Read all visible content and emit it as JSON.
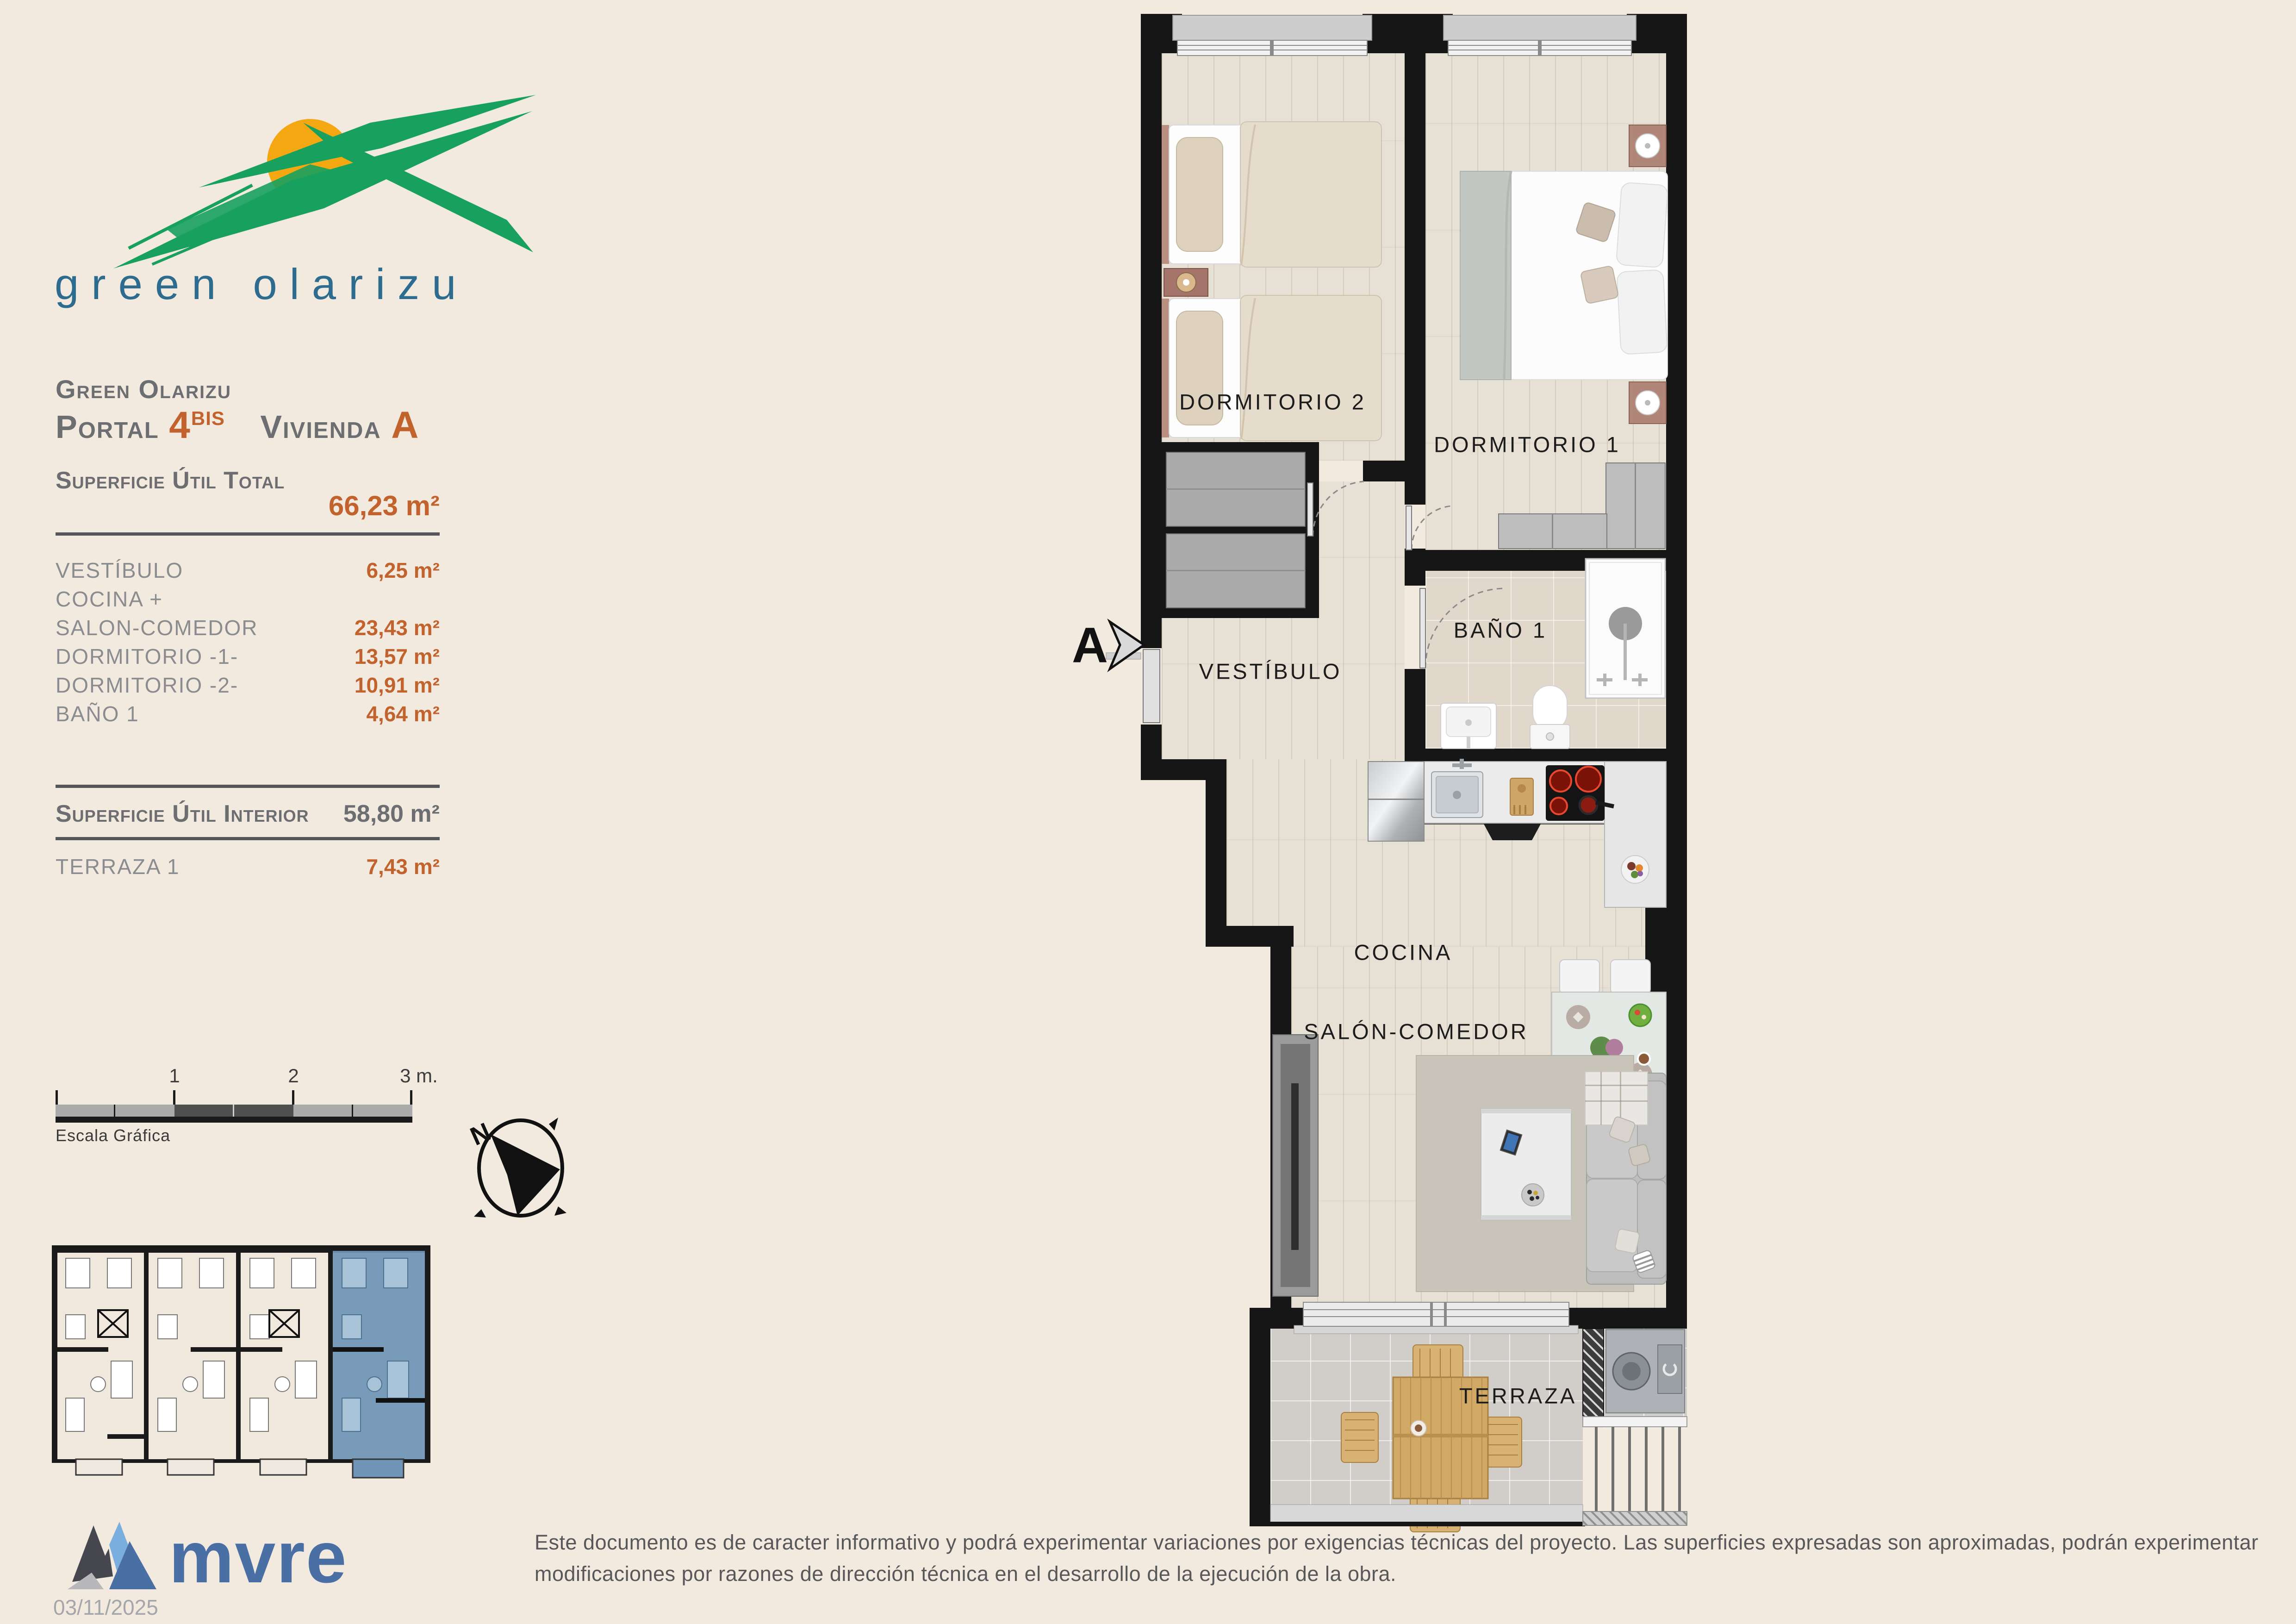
{
  "logo": {
    "text": "green olarizu"
  },
  "header": {
    "project_name": "Green Olarizu",
    "portal_label": "Portal",
    "portal_number": "4",
    "portal_sup": "BIS",
    "vivienda_label": "Vivienda",
    "vivienda_letter": "A"
  },
  "surface_total": {
    "label": "Superficie Útil Total",
    "value": "66,23 m²"
  },
  "rooms": [
    {
      "label": "VESTÍBULO",
      "value": "6,25 m²"
    },
    {
      "label": "COCINA +",
      "value": ""
    },
    {
      "label": "SALON-COMEDOR",
      "value": "23,43 m²"
    },
    {
      "label": "DORMITORIO -1-",
      "value": "13,57 m²"
    },
    {
      "label": "DORMITORIO -2-",
      "value": "10,91 m²"
    },
    {
      "label": "BAÑO 1",
      "value": "4,64 m²"
    }
  ],
  "surface_interior": {
    "label": "Superficie Útil Interior",
    "value": "58,80 m²"
  },
  "terrace_row": {
    "label": "TERRAZA 1",
    "value": "7,43 m²"
  },
  "scale_bar": {
    "tick1": "1",
    "tick2": "2",
    "tick3": "3 m.",
    "caption": "Escala Gráfica"
  },
  "compass": {
    "north_label": "N"
  },
  "plan": {
    "dormitorio2": "DORMITORIO 2",
    "dormitorio1": "DORMITORIO 1",
    "vestibulo": "VESTÍBULO",
    "bano1": "BAÑO 1",
    "cocina": "COCINA",
    "salon_comedor": "SALÓN-COMEDOR",
    "terraza": "TERRAZA",
    "section_marker": "A"
  },
  "footer": {
    "brand": "mvre",
    "date": "03/11/2025",
    "disclaimer": "Este documento es de caracter informativo y podrá experimentar variaciones por exigencias técnicas del proyecto. Las superficies expresadas son aproximadas, podrán experimentar modificaciones por razones de dirección técnica en el desarrollo de la ejecución de la obra."
  },
  "colors": {
    "accent_orange": "#c2622d",
    "text_gray": "#6d6e71",
    "logo_green": "#17a05e",
    "logo_sun_orange": "#f3a812",
    "logo_text_teal": "#2d6c8e",
    "mvre_blue": "#4a6fa5",
    "highlight_unit_blue": "#6f94b6",
    "background_cream": "#f3eadf"
  }
}
